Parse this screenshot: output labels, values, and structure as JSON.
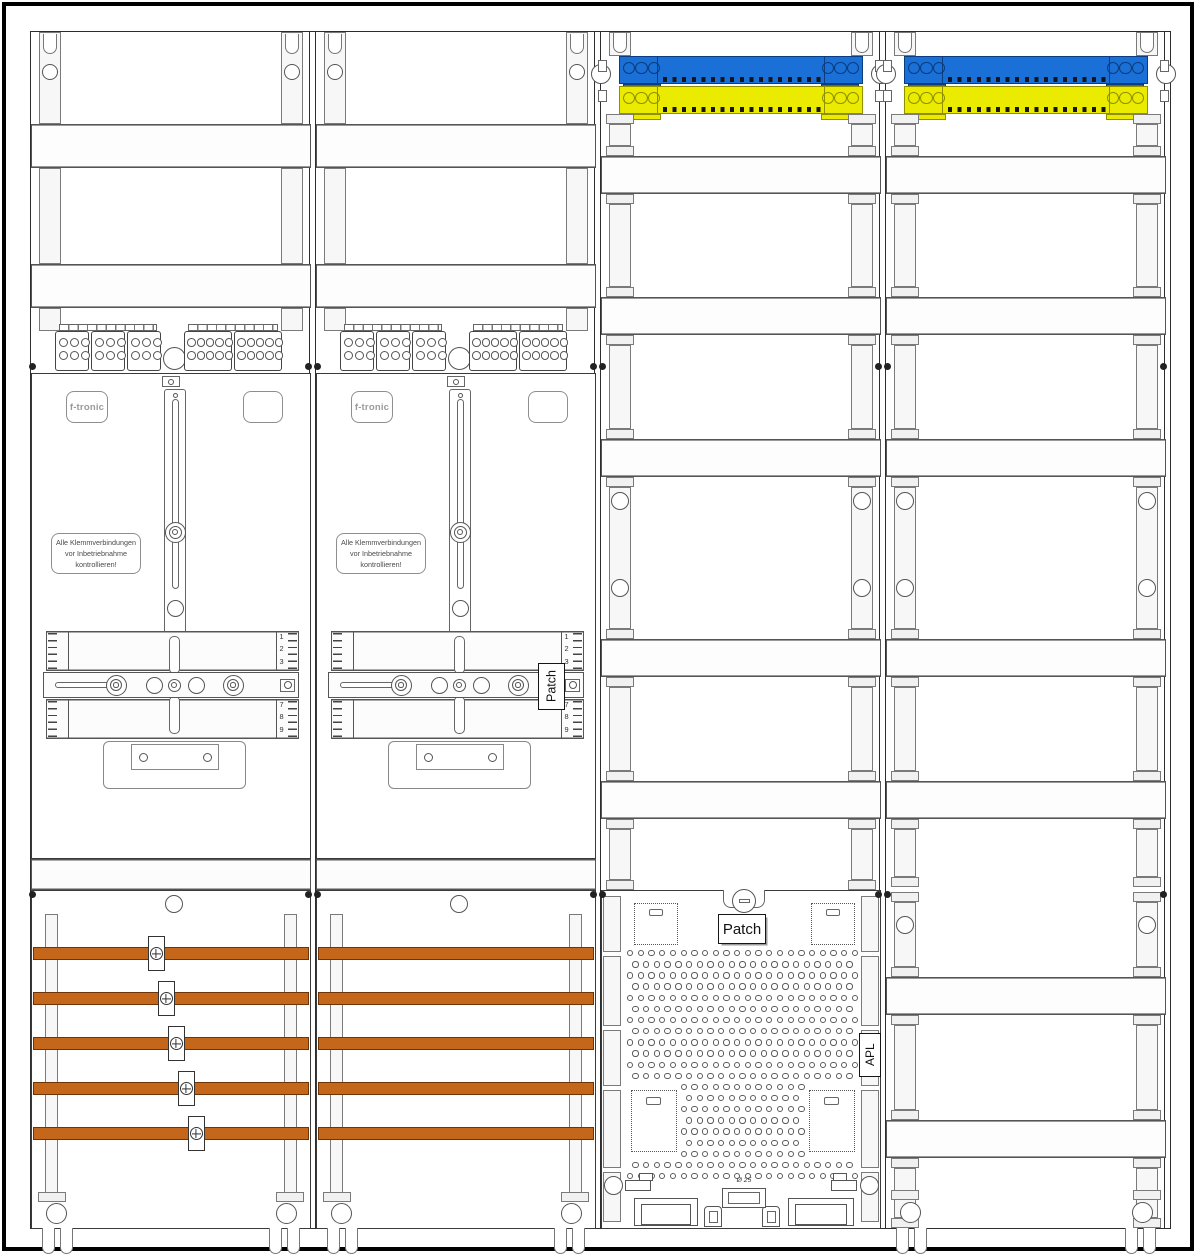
{
  "colors": {
    "background": "#ffffff",
    "frame": "#000000",
    "line_dark": "#2d2d2d",
    "line_mid": "#555555",
    "busbar": "#c4671a",
    "busbar_edge": "#6e3407",
    "neutral_blue": "#1a70d6",
    "neutral_blue_edge": "#0a3c7e",
    "pe_yellow": "#ebeb00",
    "pe_yellow_edge": "#8f8f00"
  },
  "labels": {
    "brand": "f-tronic",
    "warning": [
      "Alle Klemmverbindungen",
      "vor Inbetriebnahme",
      "kontrollieren!"
    ],
    "patch": "Patch",
    "apl": "APL",
    "knockout_diameter": "Ø 25",
    "ruler_top_digits": [
      "1",
      "2",
      "3"
    ],
    "ruler_bottom_digits": [
      "7",
      "8",
      "9"
    ]
  },
  "cabinet": {
    "fields": [
      {
        "id": 1,
        "type": "meter-field",
        "busbars": 5,
        "busbar_clamps": true,
        "din_bands": 2
      },
      {
        "id": 2,
        "type": "meter-field",
        "busbars": 5,
        "busbar_clamps": false,
        "din_bands": 2,
        "side_label": "Patch"
      },
      {
        "id": 3,
        "type": "distribution-field",
        "din_bands": 5,
        "top_bars": [
          "blue",
          "yellow"
        ],
        "bottom_label": "Patch",
        "side_label": "APL"
      },
      {
        "id": 4,
        "type": "distribution-field",
        "din_bands": 7,
        "top_bars": [
          "blue",
          "yellow"
        ]
      }
    ]
  },
  "terminal_blocks": {
    "left_groups": 3,
    "left_cols": 3,
    "right_groups": 2,
    "right_cols": 5,
    "rows": 2
  },
  "top_bars": {
    "end_holes": 3
  },
  "perforated_grid": {
    "rows": 21,
    "cols": 22
  }
}
